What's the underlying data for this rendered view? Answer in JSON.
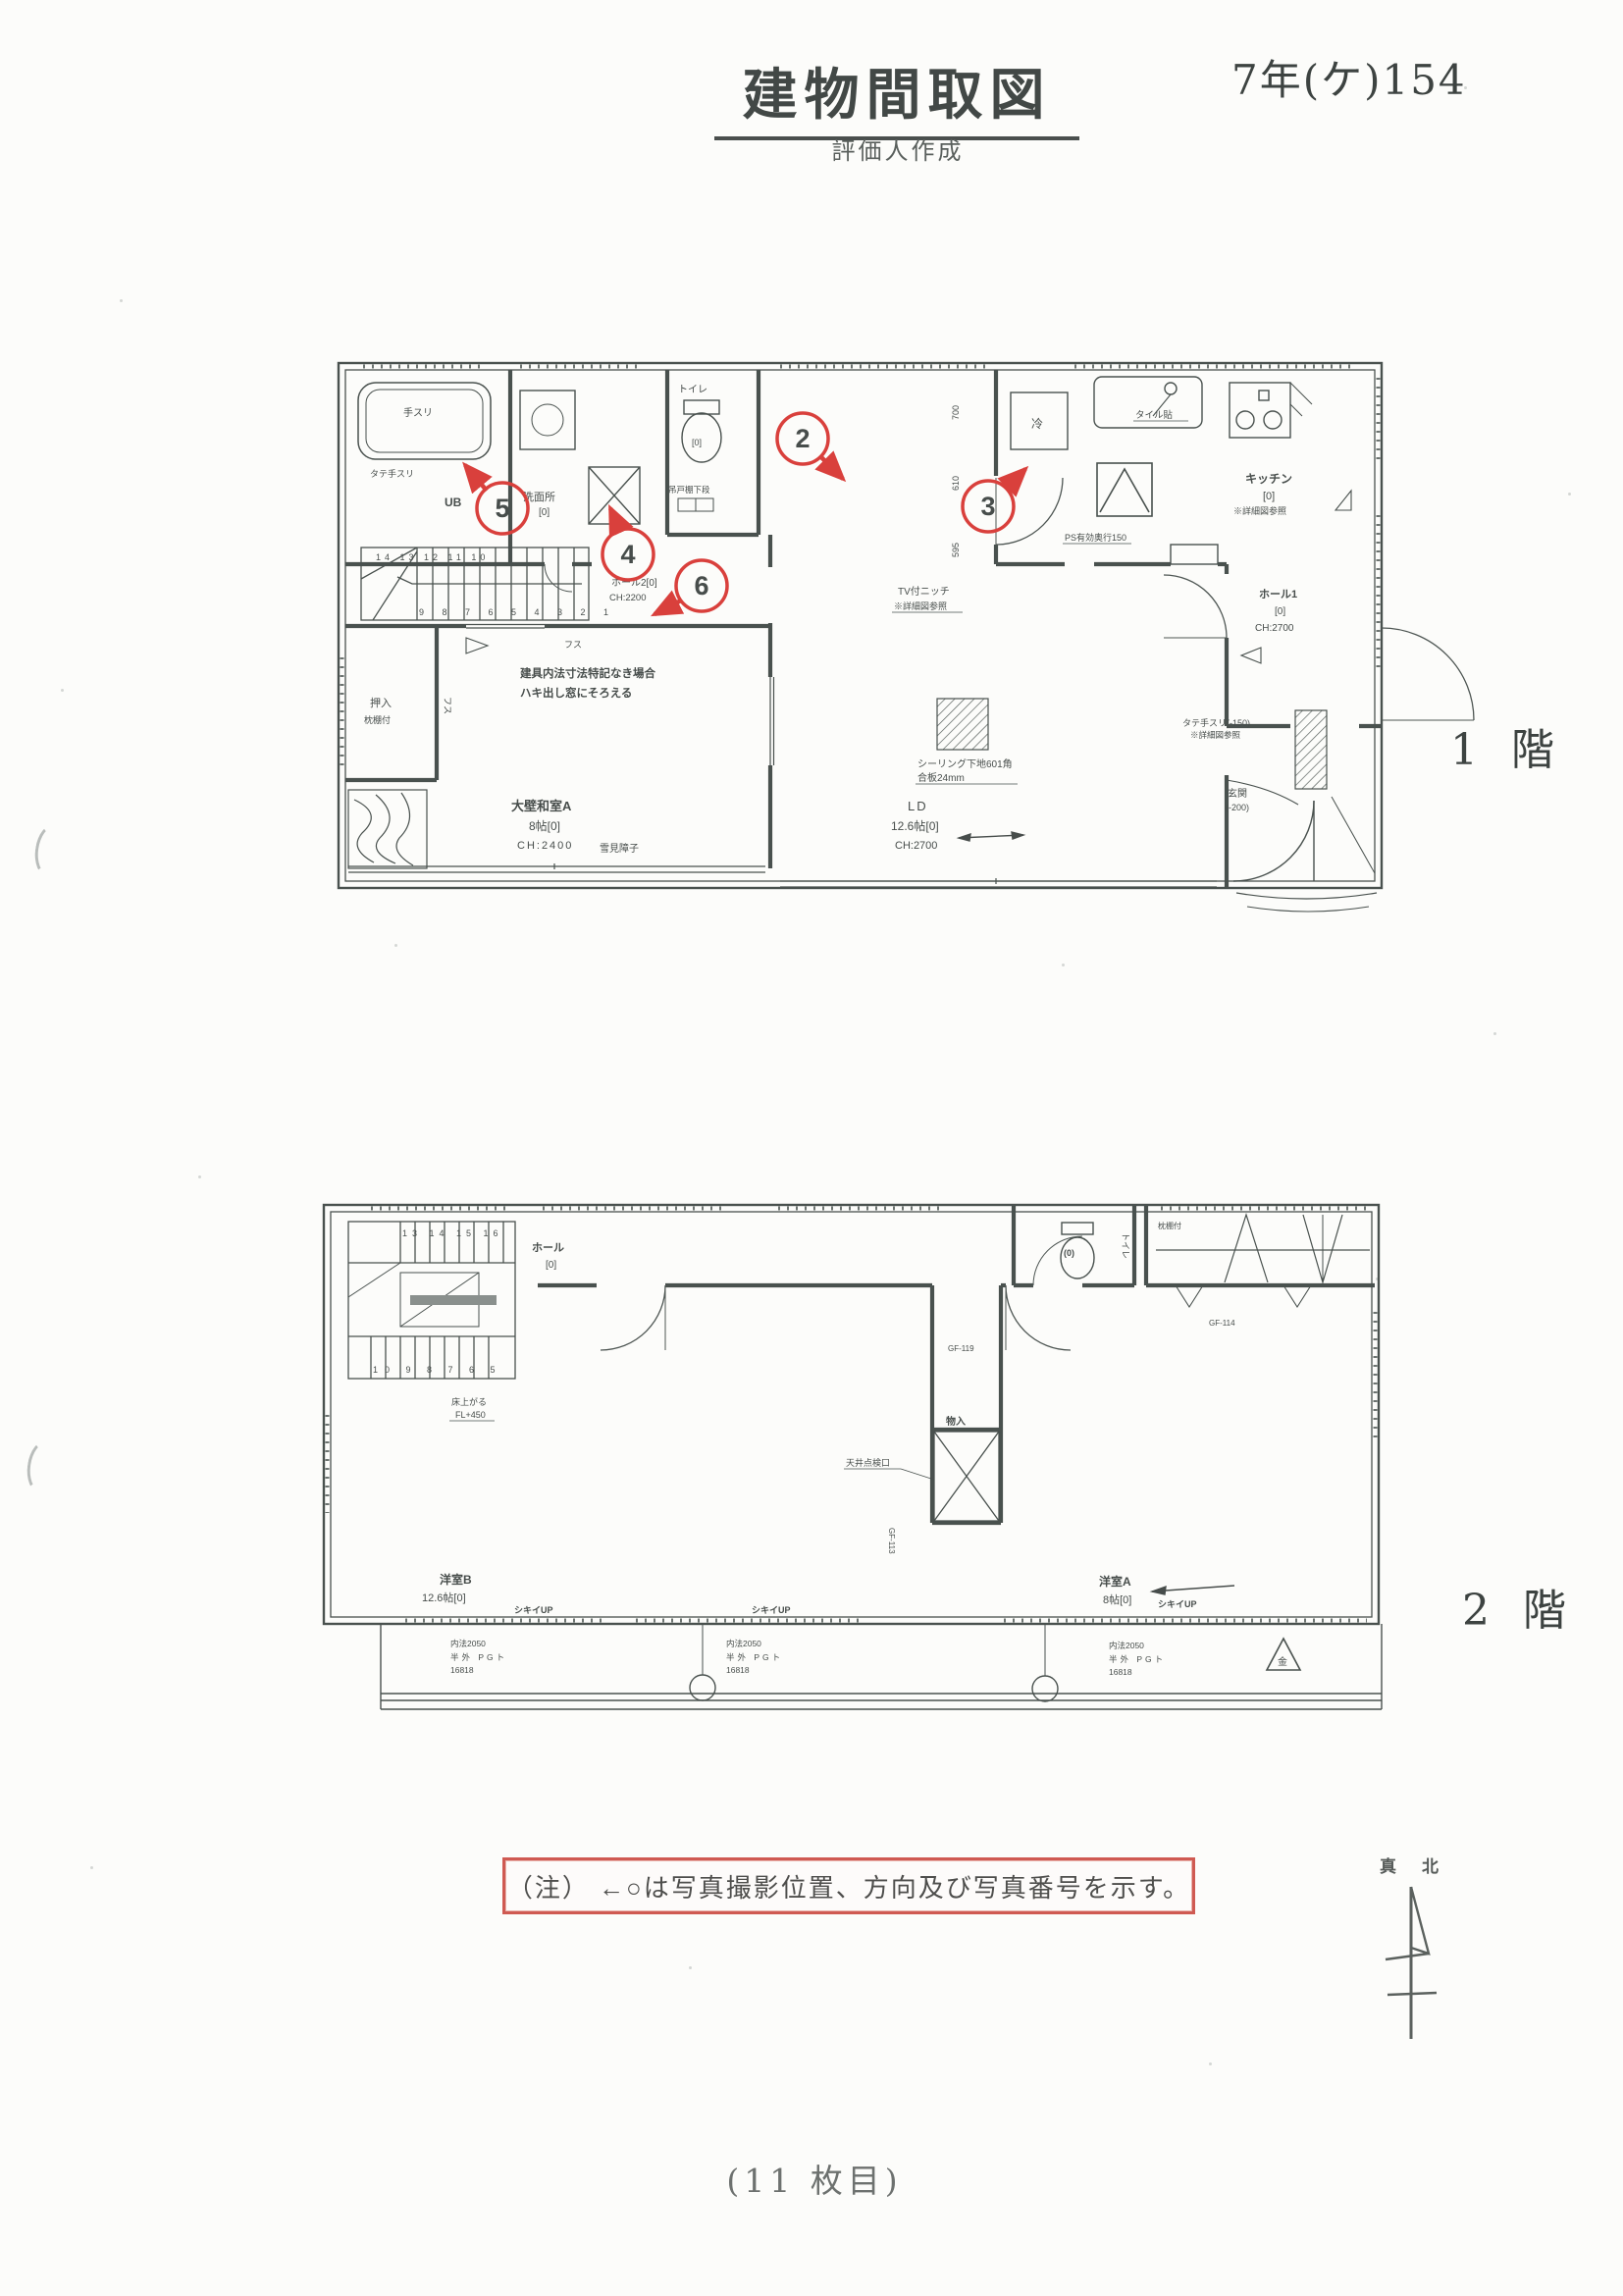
{
  "header": {
    "title": "建物間取図",
    "subtitle": "評価人作成",
    "case_number": "7年(ケ)154"
  },
  "colors": {
    "marker_red": "#d9403c",
    "note_border_red": "#cf5a52",
    "line_gray": "#4a524f"
  },
  "floor1": {
    "floor_label": "1 階",
    "photo_markers": [
      {
        "num": "2"
      },
      {
        "num": "3"
      },
      {
        "num": "4"
      },
      {
        "num": "5"
      },
      {
        "num": "6"
      }
    ],
    "stair_top_row": "14 13 12 11 10",
    "stair_bottom_row": "9 8 7 6 5 4 3 2 1",
    "labels": {
      "tesuri": "手スリ",
      "tate_tesuri": "タテ手スリ",
      "ub": "UB",
      "senmenjo": "洗面所",
      "senmenjo_size": "[0]",
      "toilet": "トイレ",
      "toilet_size": "[0]",
      "tsuridana": "吊戸棚下段",
      "hall2": "ホール2[0]",
      "hall2_ch": "CH:2200",
      "oshiire": "押入",
      "makuradana": "枕棚付",
      "fusuma": "フス",
      "note_line1": "建具内法寸法特記なき場合",
      "note_line2": "ハキ出し窓にそろえる",
      "washitsu_a": "大壁和室A",
      "washitsu_a_size": "8帖[0]",
      "washitsu_a_ch": "CH:2400",
      "shoji": "雪見障子",
      "ld": "LD",
      "ld_size": "12.6帖[0]",
      "ld_ch": "CH:2700",
      "ceiling_note1": "シーリング下地601角",
      "ceiling_note2": "合板24mm",
      "tv_niche1": "TV付ニッチ",
      "tv_niche2": "※詳細図参照",
      "rei": "冷",
      "tile": "タイル貼",
      "kitchen": "キッチン",
      "kitchen_size": "[0]",
      "kitchen_note": "※詳細図参照",
      "ps_note": "PS有効奥行150",
      "hall1": "ホール1",
      "hall1_size": "[0]",
      "hall1_ch": "CH:2700",
      "tate_tesuri2": "タテ手スリ(-150)",
      "tate_tesuri2_note": "※詳細図参照",
      "genkan": "玄関",
      "genkan_level": "(-200)",
      "dim_700": "700",
      "dim_610": "610",
      "dim_595": "595"
    }
  },
  "floor2": {
    "floor_label": "2 階",
    "stair_top_row": "13 14 15 16",
    "stair_bottom_row": "10 9 8 7 6 5",
    "labels": {
      "hall": "ホール",
      "hall_size": "[0]",
      "stairs_note1": "床上がる",
      "stairs_note2": "FL+450",
      "monoire": "物入",
      "tenjo_tenkenko": "天井点検口",
      "gf113": "GF-113",
      "gf119": "GF-119",
      "gf114": "GF-114",
      "toilet_size": "(0)",
      "toilet": "トイレ",
      "makuradana": "枕棚付",
      "yoshitsu_b": "洋室B",
      "yoshitsu_b_size": "12.6帖[0]",
      "yoshitsu_a": "洋室A",
      "yoshitsu_a_size": "8帖[0]",
      "shikii_up": "シキイUP",
      "window_spec1": "内法2050",
      "window_spec2": "半外 PGト",
      "window_spec3": "16818",
      "kin": "金"
    }
  },
  "note": {
    "text": "（注） ←○は写真撮影位置、方向及び写真番号を示す。"
  },
  "compass": {
    "label": "真北"
  },
  "footer": {
    "page_label": "(11 枚目)"
  }
}
